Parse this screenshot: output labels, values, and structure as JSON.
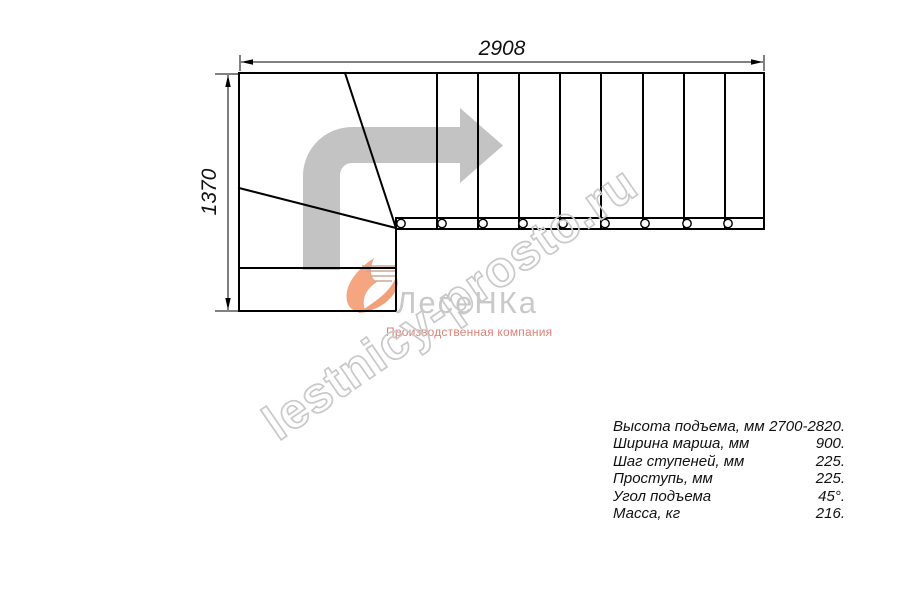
{
  "drawing": {
    "width_dimension": "2908",
    "height_dimension": "1370",
    "tread_count": 9,
    "type": "L-shaped staircase plan view with winder steps and direction arrow"
  },
  "watermark": {
    "text": "lestnicy-prosto.ru"
  },
  "logo": {
    "name": "ЛесеНКа",
    "subtitle": "Производственная компания"
  },
  "specs": {
    "rows": [
      {
        "label": "Высота подъема, мм",
        "value": "2700-2820."
      },
      {
        "label": "Ширина марша, мм",
        "value": "900."
      },
      {
        "label": "Шаг ступеней, мм",
        "value": "225."
      },
      {
        "label": "Проступь, мм",
        "value": "225."
      },
      {
        "label": "Угол подъема",
        "value": "45°."
      },
      {
        "label": "Масса, кг",
        "value": "216."
      }
    ]
  },
  "colors": {
    "line_black": "#000000",
    "arrow_gray": "#c3c3c3",
    "watermark_gray": "#c9c9c9",
    "logo_orange": "#f5a57f",
    "logo_text_gray": "#c9c9c9",
    "logo_subtitle_red": "#de8175",
    "background": "#ffffff"
  }
}
